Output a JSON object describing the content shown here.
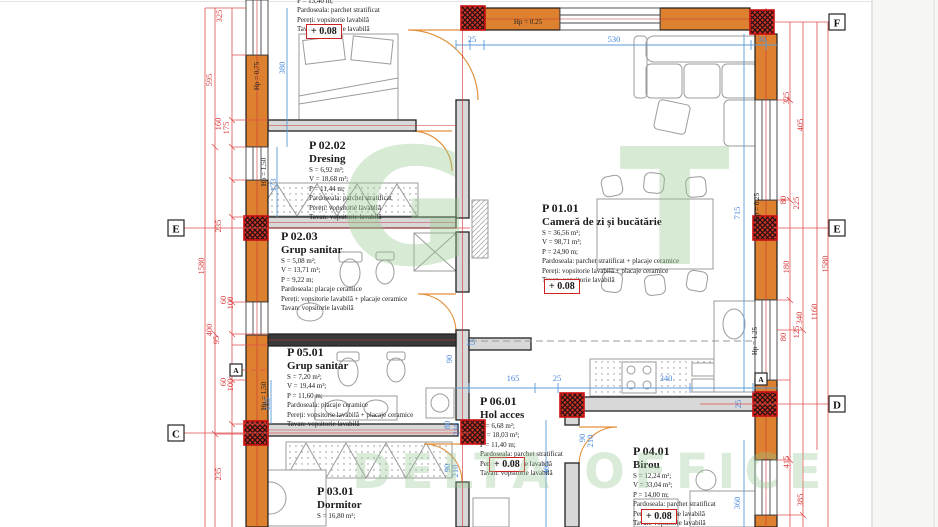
{
  "watermark": {
    "top": "G T",
    "bottom": "DELTA OFFICE"
  },
  "markers": {
    "e_left": "E",
    "c_left": "C",
    "f_right": "F",
    "e_right": "E",
    "d_right": "D",
    "a1": "A",
    "a2": "A"
  },
  "hp": {
    "t": "Hp = 0.25",
    "lt": "Hp = 0,75",
    "lm": "Hp = 1,50",
    "lb": "Hp = 1,50",
    "rt": "Hp = 0.25",
    "rb": "Hp = 1.25"
  },
  "rooms": {
    "cut_top": {
      "perimeter": "P = 13,40 m;",
      "floor": "Pardoseala: parchet stratificat",
      "walls": "Pereți: vopsitorie lavabilă",
      "ceiling": "Tavan: vopsitorie lavabilă",
      "level": "+ 0.08"
    },
    "p0202": {
      "id": "P 02.02",
      "name": "Dresing",
      "area": "S = 6,92 m²;",
      "volume": "V = 18,68 m³;",
      "perimeter": "P = 11,44 m;",
      "floor": "Pardoseala: parchet stratificat",
      "walls": "Pereți: vopsitorie lavabilă",
      "ceiling": "Tavan: vopsitorie lavabilă"
    },
    "p0203": {
      "id": "P 02.03",
      "name": "Grup sanitar",
      "area": "S = 5,08 m²;",
      "volume": "V = 13,71 m³;",
      "perimeter": "P = 9,22 m;",
      "floor": "Pardoseala: placaje ceramice",
      "walls": "Pereți: vopsitorie lavabilă + placaje ceramice",
      "ceiling": "Tavan: vopsitorie lavabilă"
    },
    "p0501": {
      "id": "P 05.01",
      "name": "Grup sanitar",
      "area": "S = 7,20 m²;",
      "volume": "V = 19,44 m³;",
      "perimeter": "P = 11,60 m;",
      "floor": "Pardoseala: placaje ceramice",
      "walls": "Pereți: vopsitorie lavabilă + placaje ceramice",
      "ceiling": "Tavan: vopsitorie lavabilă"
    },
    "p0101": {
      "id": "P 01.01",
      "name": "Cameră de zi și bucătărie",
      "area": "S = 36,56 m²;",
      "volume": "V = 98,71 m³;",
      "perimeter": "P = 24,90 m;",
      "floor": "Pardoseala: parchet stratificat + placaje ceramice",
      "walls": "Pereți: vopsitorie lavabilă + placaje ceramice",
      "ceiling": "Tavan: vopsitorie lavabilă",
      "level": "+ 0.08"
    },
    "p0601": {
      "id": "P 06.01",
      "name": "Hol acces",
      "area": "S = 6,68 m²;",
      "volume": "V = 18,03 m³;",
      "perimeter": "P = 11,40 m;",
      "floor": "Pardoseala: parchet stratificat",
      "walls": "Pereți: vopsitorie lavabilă",
      "ceiling": "Tavan: vopsitorie lavabilă",
      "level": "+ 0.08"
    },
    "p0401": {
      "id": "P 04.01",
      "name": "Birou",
      "area": "S = 12,24 m²;",
      "volume": "V = 33,04 m³;",
      "perimeter": "P = 14,00 m;",
      "floor": "Pardoseala: parchet stratificat",
      "walls": "Pereți: vopsitorie lavabilă",
      "ceiling": "Tavan: vopsitorie lavabilă",
      "level": "+ 0.08"
    },
    "p0301": {
      "id": "P 03.01",
      "name": "Dormitor",
      "area": "S = 16,80 m²;"
    }
  },
  "dims": {
    "rl_325": "325",
    "rl_595": "595",
    "rl_160": "160",
    "rl_175": "175",
    "rl_235a": "235",
    "rl_1580": "1580",
    "rl_400": "400",
    "rl_95": "95",
    "rl_60a": "60",
    "rl_100a": "100",
    "rl_60b": "60",
    "rl_100b": "100",
    "rl_235b": "235",
    "rr_325": "325",
    "rr_405": "405",
    "rr_80a": "80",
    "rr_225": "225",
    "rr_1580": "1580",
    "rr_180": "180",
    "rr_340": "340",
    "rr_1160": "1160",
    "rr_125": "125",
    "rr_80b": "80",
    "rr_415": "415",
    "rr_385": "385",
    "bt_25": "25",
    "bt_530": "530",
    "bt_30": "30",
    "bl_380": "380",
    "bl_173": "173",
    "bl_135": "135",
    "bv_715": "715",
    "bv_405": "405",
    "bv_360": "360",
    "bh_165": "165",
    "bh_25a": "25",
    "bh_340": "340",
    "bh_30": "30",
    "bh_25b": "25",
    "bh_25c": "25",
    "bd_90a": "90",
    "bd_80": "80",
    "bd_210a": "210",
    "bd_90b": "90",
    "bd_210b": "210",
    "bd_90c": "90",
    "bd_210c": "210"
  }
}
